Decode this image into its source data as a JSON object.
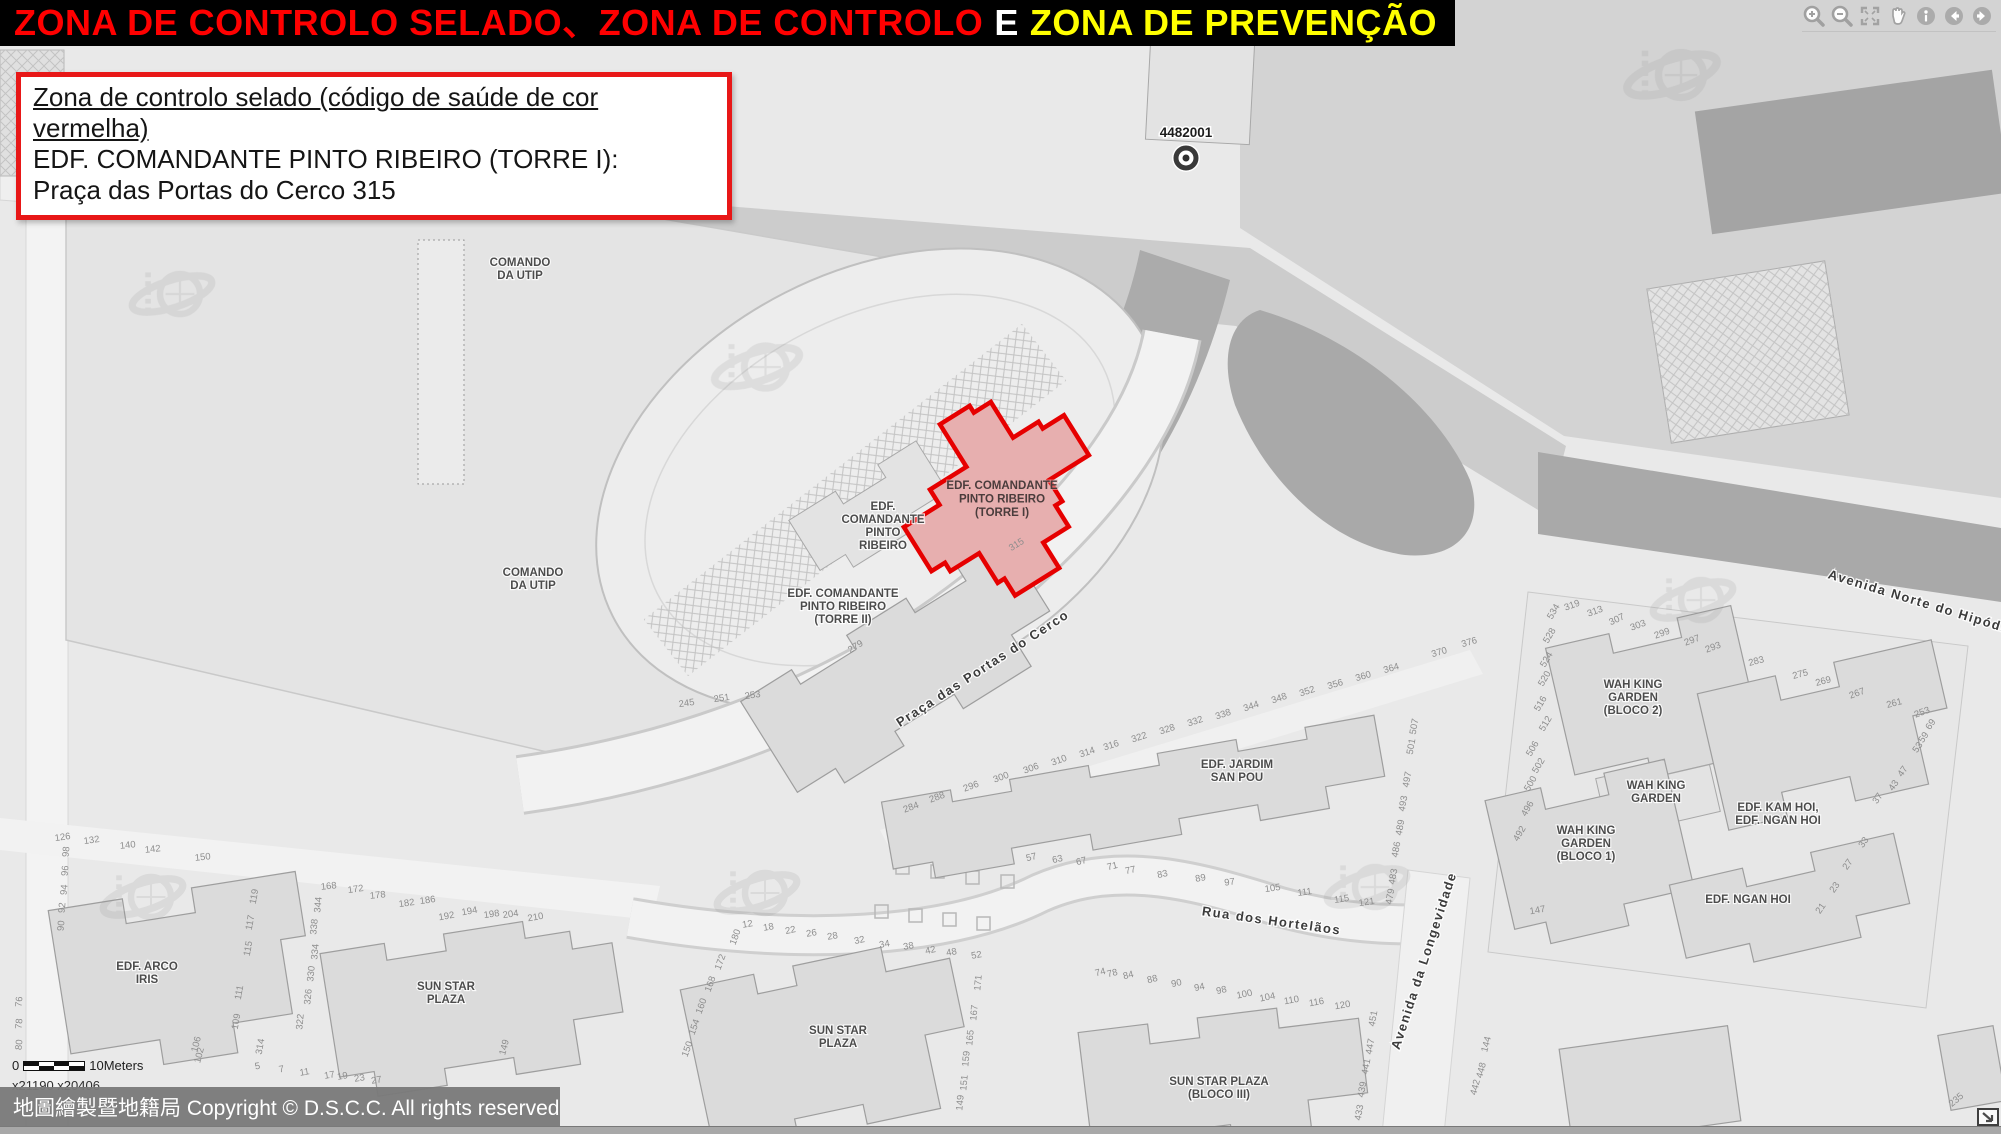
{
  "title": {
    "seg1": "ZONA DE CONTROLO SELADO、ZONA DE CONTROLO",
    "seg2": "E",
    "seg3": "ZONA DE PREVENÇÃO"
  },
  "info_box": {
    "line1": "Zona de controlo selado (código de saúde de cor vermelha)",
    "line2": "EDF. COMANDANTE PINTO RIBEIRO (TORRE I):",
    "line3": "Praça das Portas do Cerco 315"
  },
  "toolbar": {
    "icons": [
      "zoom-in",
      "zoom-out",
      "full-extent",
      "pan",
      "identify",
      "previous-extent",
      "next-extent"
    ]
  },
  "scale": {
    "start": "0",
    "end": "10Meters",
    "coords": "x21190 x20406"
  },
  "copyright": {
    "text": "地圖繪製暨地籍局 Copyright © D.S.C.C. All rights reserved"
  },
  "colors": {
    "title_red": "#ff0000",
    "title_yellow": "#ffff00",
    "accent_red": "#e81717",
    "zone_stroke": "#e60000",
    "zone_fill": "#e7afaf",
    "map_bg": "#e9e9e9"
  },
  "map": {
    "marker": {
      "label": "4482001"
    },
    "zone": {
      "label_lines": [
        "EDF. COMANDANTE",
        "PINTO RIBEIRO",
        "(TORRE I)"
      ],
      "label_x": 1002,
      "label_y": 489,
      "number": "315",
      "number_x": 1018,
      "number_y": 547,
      "number_r": -32
    },
    "building_labels": [
      {
        "lines": [
          "COMANDO",
          "DA UTIP"
        ],
        "x": 520,
        "y": 266
      },
      {
        "lines": [
          "COMANDO",
          "DA UTIP"
        ],
        "x": 533,
        "y": 576
      },
      {
        "lines": [
          "EDF.",
          "COMANDANTE",
          "PINTO",
          "RIBEIRO"
        ],
        "x": 883,
        "y": 510
      },
      {
        "lines": [
          "EDF. COMANDANTE",
          "PINTO RIBEIRO",
          "(TORRE II)"
        ],
        "x": 843,
        "y": 597
      },
      {
        "lines": [
          "EDF. JARDIM",
          "SAN POU"
        ],
        "x": 1237,
        "y": 768
      },
      {
        "lines": [
          "EDF. ARCO",
          "IRIS"
        ],
        "x": 147,
        "y": 970
      },
      {
        "lines": [
          "SUN STAR",
          "PLAZA"
        ],
        "x": 446,
        "y": 990
      },
      {
        "lines": [
          "SUN STAR",
          "PLAZA"
        ],
        "x": 838,
        "y": 1034
      },
      {
        "lines": [
          "SUN STAR PLAZA",
          "(BLOCO III)"
        ],
        "x": 1219,
        "y": 1085
      },
      {
        "lines": [
          "WAH KING",
          "GARDEN",
          "(BLOCO 2)"
        ],
        "x": 1633,
        "y": 688
      },
      {
        "lines": [
          "WAH KING",
          "GARDEN"
        ],
        "x": 1656,
        "y": 789
      },
      {
        "lines": [
          "WAH KING",
          "GARDEN",
          "(BLOCO 1)"
        ],
        "x": 1586,
        "y": 834
      },
      {
        "lines": [
          "EDF. KAM HOI,",
          "EDF. NGAN HOI"
        ],
        "x": 1778,
        "y": 811
      },
      {
        "lines": [
          "EDF. NGAN HOI"
        ],
        "x": 1748,
        "y": 903
      }
    ],
    "street_labels": [
      {
        "text": "Praça das Portas do Cerco",
        "x": 985,
        "y": 672,
        "r": -33
      },
      {
        "text": "Rua dos Hortelãos",
        "x": 1271,
        "y": 925,
        "r": 8
      },
      {
        "text": "Avenida da Longevidade",
        "x": 1428,
        "y": 962,
        "r": -72
      },
      {
        "text": "Avenida Norte do Hipódromo",
        "x": 1932,
        "y": 610,
        "r": 17
      }
    ],
    "house_numbers": [
      {
        "t": "126",
        "x": 63,
        "y": 840,
        "r": -8
      },
      {
        "t": "132",
        "x": 92,
        "y": 843,
        "r": -8
      },
      {
        "t": "140",
        "x": 128,
        "y": 848,
        "r": -6
      },
      {
        "t": "142",
        "x": 153,
        "y": 852,
        "r": -6
      },
      {
        "t": "150",
        "x": 203,
        "y": 860,
        "r": -6
      },
      {
        "t": "168",
        "x": 329,
        "y": 889,
        "r": -6
      },
      {
        "t": "172",
        "x": 356,
        "y": 892,
        "r": -8
      },
      {
        "t": "178",
        "x": 378,
        "y": 898,
        "r": -6
      },
      {
        "t": "182",
        "x": 407,
        "y": 906,
        "r": -8
      },
      {
        "t": "186",
        "x": 428,
        "y": 903,
        "r": -8
      },
      {
        "t": "192",
        "x": 447,
        "y": 919,
        "r": -10
      },
      {
        "t": "194",
        "x": 470,
        "y": 914,
        "r": -10
      },
      {
        "t": "198",
        "x": 492,
        "y": 917,
        "r": -8
      },
      {
        "t": "204",
        "x": 511,
        "y": 917,
        "r": -8
      },
      {
        "t": "210",
        "x": 536,
        "y": 920,
        "r": -10
      },
      {
        "t": "98",
        "x": 69,
        "y": 852,
        "r": -85
      },
      {
        "t": "96",
        "x": 68,
        "y": 871,
        "r": -85
      },
      {
        "t": "94",
        "x": 67,
        "y": 890,
        "r": -85
      },
      {
        "t": "92",
        "x": 65,
        "y": 908,
        "r": -85
      },
      {
        "t": "90",
        "x": 64,
        "y": 926,
        "r": -85
      },
      {
        "t": "119",
        "x": 257,
        "y": 897,
        "r": -80
      },
      {
        "t": "117",
        "x": 253,
        "y": 923,
        "r": -80
      },
      {
        "t": "115",
        "x": 251,
        "y": 949,
        "r": -80
      },
      {
        "t": "111",
        "x": 242,
        "y": 993,
        "r": -80
      },
      {
        "t": "109",
        "x": 239,
        "y": 1022,
        "r": -80
      },
      {
        "t": "344",
        "x": 321,
        "y": 905,
        "r": -85
      },
      {
        "t": "338",
        "x": 317,
        "y": 927,
        "r": -85
      },
      {
        "t": "334",
        "x": 318,
        "y": 952,
        "r": -85
      },
      {
        "t": "330",
        "x": 314,
        "y": 974,
        "r": -85
      },
      {
        "t": "326",
        "x": 311,
        "y": 997,
        "r": -85
      },
      {
        "t": "322",
        "x": 303,
        "y": 1022,
        "r": -85
      },
      {
        "t": "5",
        "x": 258,
        "y": 1069,
        "r": -10
      },
      {
        "t": "7",
        "x": 282,
        "y": 1072,
        "r": -10
      },
      {
        "t": "11",
        "x": 305,
        "y": 1075,
        "r": -10
      },
      {
        "t": "17",
        "x": 330,
        "y": 1078,
        "r": -10
      },
      {
        "t": "19",
        "x": 343,
        "y": 1079,
        "r": -10
      },
      {
        "t": "23",
        "x": 360,
        "y": 1081,
        "r": -10
      },
      {
        "t": "27",
        "x": 377,
        "y": 1083,
        "r": -10
      },
      {
        "t": "314",
        "x": 263,
        "y": 1047,
        "r": -80
      },
      {
        "t": "149",
        "x": 507,
        "y": 1048,
        "r": -75
      },
      {
        "t": "106",
        "x": 199,
        "y": 1045,
        "r": -75
      },
      {
        "t": "102",
        "x": 202,
        "y": 1056,
        "r": -75
      },
      {
        "t": "76",
        "x": 22,
        "y": 1002,
        "r": -85
      },
      {
        "t": "78",
        "x": 22,
        "y": 1024,
        "r": -85
      },
      {
        "t": "80",
        "x": 22,
        "y": 1045,
        "r": -85
      },
      {
        "t": "12",
        "x": 748,
        "y": 927,
        "r": -10
      },
      {
        "t": "18",
        "x": 769,
        "y": 930,
        "r": -10
      },
      {
        "t": "22",
        "x": 791,
        "y": 933,
        "r": -12
      },
      {
        "t": "26",
        "x": 812,
        "y": 936,
        "r": -10
      },
      {
        "t": "28",
        "x": 833,
        "y": 939,
        "r": -10
      },
      {
        "t": "32",
        "x": 860,
        "y": 943,
        "r": -12
      },
      {
        "t": "34",
        "x": 885,
        "y": 947,
        "r": -10
      },
      {
        "t": "38",
        "x": 909,
        "y": 949,
        "r": -10
      },
      {
        "t": "42",
        "x": 931,
        "y": 953,
        "r": -12
      },
      {
        "t": "48",
        "x": 952,
        "y": 955,
        "r": -10
      },
      {
        "t": "52",
        "x": 977,
        "y": 958,
        "r": -10
      },
      {
        "t": "57",
        "x": 1032,
        "y": 860,
        "r": -14
      },
      {
        "t": "63",
        "x": 1058,
        "y": 862,
        "r": -12
      },
      {
        "t": "67",
        "x": 1082,
        "y": 864,
        "r": -14
      },
      {
        "t": "71",
        "x": 1113,
        "y": 869,
        "r": -14
      },
      {
        "t": "77",
        "x": 1131,
        "y": 873,
        "r": -12
      },
      {
        "t": "83",
        "x": 1163,
        "y": 877,
        "r": -12
      },
      {
        "t": "89",
        "x": 1201,
        "y": 881,
        "r": -10
      },
      {
        "t": "97",
        "x": 1230,
        "y": 885,
        "r": -8
      },
      {
        "t": "105",
        "x": 1273,
        "y": 891,
        "r": -8
      },
      {
        "t": "111",
        "x": 1305,
        "y": 895,
        "r": -8
      },
      {
        "t": "115",
        "x": 1342,
        "y": 902,
        "r": -8
      },
      {
        "t": "121",
        "x": 1367,
        "y": 905,
        "r": -8
      },
      {
        "t": "180",
        "x": 738,
        "y": 938,
        "r": -70
      },
      {
        "t": "172",
        "x": 723,
        "y": 963,
        "r": -70
      },
      {
        "t": "168",
        "x": 713,
        "y": 985,
        "r": -70
      },
      {
        "t": "160",
        "x": 704,
        "y": 1007,
        "r": -70
      },
      {
        "t": "154",
        "x": 697,
        "y": 1028,
        "r": -70
      },
      {
        "t": "150",
        "x": 690,
        "y": 1050,
        "r": -70
      },
      {
        "t": "171",
        "x": 981,
        "y": 983,
        "r": -85
      },
      {
        "t": "167",
        "x": 977,
        "y": 1013,
        "r": -85
      },
      {
        "t": "165",
        "x": 973,
        "y": 1038,
        "r": -85
      },
      {
        "t": "159",
        "x": 969,
        "y": 1059,
        "r": -85
      },
      {
        "t": "151",
        "x": 967,
        "y": 1083,
        "r": -85
      },
      {
        "t": "149",
        "x": 963,
        "y": 1103,
        "r": -85
      },
      {
        "t": "74",
        "x": 1101,
        "y": 975,
        "r": -14
      },
      {
        "t": "78",
        "x": 1113,
        "y": 976,
        "r": -14
      },
      {
        "t": "84",
        "x": 1129,
        "y": 978,
        "r": -14
      },
      {
        "t": "88",
        "x": 1153,
        "y": 982,
        "r": -14
      },
      {
        "t": "90",
        "x": 1177,
        "y": 986,
        "r": -12
      },
      {
        "t": "94",
        "x": 1200,
        "y": 990,
        "r": -12
      },
      {
        "t": "98",
        "x": 1222,
        "y": 993,
        "r": -12
      },
      {
        "t": "100",
        "x": 1245,
        "y": 997,
        "r": -12
      },
      {
        "t": "104",
        "x": 1268,
        "y": 1000,
        "r": -12
      },
      {
        "t": "110",
        "x": 1292,
        "y": 1003,
        "r": -10
      },
      {
        "t": "116",
        "x": 1317,
        "y": 1005,
        "r": -10
      },
      {
        "t": "120",
        "x": 1343,
        "y": 1008,
        "r": -10
      },
      {
        "t": "451",
        "x": 1376,
        "y": 1019,
        "r": -80
      },
      {
        "t": "447",
        "x": 1373,
        "y": 1047,
        "r": -80
      },
      {
        "t": "441",
        "x": 1369,
        "y": 1067,
        "r": -80
      },
      {
        "t": "439",
        "x": 1365,
        "y": 1090,
        "r": -80
      },
      {
        "t": "433",
        "x": 1362,
        "y": 1113,
        "r": -80
      },
      {
        "t": "507",
        "x": 1417,
        "y": 727,
        "r": -80
      },
      {
        "t": "501",
        "x": 1414,
        "y": 747,
        "r": -80
      },
      {
        "t": "497",
        "x": 1410,
        "y": 780,
        "r": -80
      },
      {
        "t": "493",
        "x": 1406,
        "y": 804,
        "r": -80
      },
      {
        "t": "489",
        "x": 1403,
        "y": 828,
        "r": -80
      },
      {
        "t": "486",
        "x": 1399,
        "y": 850,
        "r": -80
      },
      {
        "t": "483",
        "x": 1396,
        "y": 877,
        "r": -80
      },
      {
        "t": "479",
        "x": 1393,
        "y": 897,
        "r": -80
      },
      {
        "t": "144",
        "x": 1489,
        "y": 1045,
        "r": -75
      },
      {
        "t": "448",
        "x": 1484,
        "y": 1071,
        "r": -75
      },
      {
        "t": "442",
        "x": 1478,
        "y": 1088,
        "r": -75
      },
      {
        "t": "245",
        "x": 687,
        "y": 706,
        "r": -8
      },
      {
        "t": "251",
        "x": 722,
        "y": 701,
        "r": -8
      },
      {
        "t": "253",
        "x": 753,
        "y": 698,
        "r": -8
      },
      {
        "t": "279",
        "x": 857,
        "y": 649,
        "r": -32
      },
      {
        "t": "284",
        "x": 912,
        "y": 810,
        "r": -20
      },
      {
        "t": "288",
        "x": 938,
        "y": 800,
        "r": -20
      },
      {
        "t": "296",
        "x": 972,
        "y": 789,
        "r": -20
      },
      {
        "t": "300",
        "x": 1002,
        "y": 780,
        "r": -20
      },
      {
        "t": "306",
        "x": 1032,
        "y": 771,
        "r": -20
      },
      {
        "t": "310",
        "x": 1060,
        "y": 763,
        "r": -20
      },
      {
        "t": "314",
        "x": 1088,
        "y": 755,
        "r": -18
      },
      {
        "t": "316",
        "x": 1112,
        "y": 748,
        "r": -18
      },
      {
        "t": "322",
        "x": 1140,
        "y": 740,
        "r": -18
      },
      {
        "t": "328",
        "x": 1168,
        "y": 732,
        "r": -18
      },
      {
        "t": "332",
        "x": 1196,
        "y": 724,
        "r": -18
      },
      {
        "t": "338",
        "x": 1224,
        "y": 717,
        "r": -18
      },
      {
        "t": "344",
        "x": 1252,
        "y": 709,
        "r": -18
      },
      {
        "t": "348",
        "x": 1280,
        "y": 701,
        "r": -18
      },
      {
        "t": "352",
        "x": 1308,
        "y": 694,
        "r": -18
      },
      {
        "t": "356",
        "x": 1336,
        "y": 687,
        "r": -16
      },
      {
        "t": "360",
        "x": 1364,
        "y": 679,
        "r": -16
      },
      {
        "t": "364",
        "x": 1392,
        "y": 671,
        "r": -16
      },
      {
        "t": "370",
        "x": 1440,
        "y": 655,
        "r": -16
      },
      {
        "t": "376",
        "x": 1470,
        "y": 645,
        "r": -16
      },
      {
        "t": "534",
        "x": 1556,
        "y": 613,
        "r": -60
      },
      {
        "t": "528",
        "x": 1552,
        "y": 637,
        "r": -60
      },
      {
        "t": "524",
        "x": 1549,
        "y": 661,
        "r": -60
      },
      {
        "t": "520",
        "x": 1547,
        "y": 680,
        "r": -60
      },
      {
        "t": "516",
        "x": 1543,
        "y": 705,
        "r": -60
      },
      {
        "t": "512",
        "x": 1548,
        "y": 725,
        "r": -60
      },
      {
        "t": "506",
        "x": 1535,
        "y": 750,
        "r": -60
      },
      {
        "t": "502",
        "x": 1541,
        "y": 767,
        "r": -60
      },
      {
        "t": "500",
        "x": 1533,
        "y": 785,
        "r": -60
      },
      {
        "t": "496",
        "x": 1530,
        "y": 810,
        "r": -60
      },
      {
        "t": "492",
        "x": 1522,
        "y": 835,
        "r": -60
      },
      {
        "t": "319",
        "x": 1573,
        "y": 608,
        "r": -20
      },
      {
        "t": "313",
        "x": 1596,
        "y": 614,
        "r": -20
      },
      {
        "t": "307",
        "x": 1618,
        "y": 622,
        "r": -25
      },
      {
        "t": "303",
        "x": 1639,
        "y": 628,
        "r": -20
      },
      {
        "t": "299",
        "x": 1663,
        "y": 636,
        "r": -20
      },
      {
        "t": "297",
        "x": 1693,
        "y": 643,
        "r": -20
      },
      {
        "t": "293",
        "x": 1714,
        "y": 650,
        "r": -20
      },
      {
        "t": "283",
        "x": 1757,
        "y": 664,
        "r": -15
      },
      {
        "t": "275",
        "x": 1801,
        "y": 677,
        "r": -15
      },
      {
        "t": "269",
        "x": 1824,
        "y": 684,
        "r": -15
      },
      {
        "t": "267",
        "x": 1858,
        "y": 696,
        "r": -20
      },
      {
        "t": "261",
        "x": 1895,
        "y": 706,
        "r": -15
      },
      {
        "t": "253",
        "x": 1923,
        "y": 715,
        "r": -20
      },
      {
        "t": "69",
        "x": 1933,
        "y": 726,
        "r": -55
      },
      {
        "t": "59",
        "x": 1926,
        "y": 739,
        "r": -55
      },
      {
        "t": "53",
        "x": 1920,
        "y": 749,
        "r": -55
      },
      {
        "t": "47",
        "x": 1905,
        "y": 773,
        "r": -55
      },
      {
        "t": "43",
        "x": 1896,
        "y": 787,
        "r": -55
      },
      {
        "t": "37",
        "x": 1880,
        "y": 800,
        "r": -55
      },
      {
        "t": "33",
        "x": 1866,
        "y": 844,
        "r": -55
      },
      {
        "t": "27",
        "x": 1850,
        "y": 866,
        "r": -55
      },
      {
        "t": "23",
        "x": 1837,
        "y": 889,
        "r": -55
      },
      {
        "t": "21",
        "x": 1823,
        "y": 910,
        "r": -55
      },
      {
        "t": "147",
        "x": 1538,
        "y": 913,
        "r": -10
      },
      {
        "t": "235",
        "x": 1958,
        "y": 1102,
        "r": -40
      }
    ]
  }
}
